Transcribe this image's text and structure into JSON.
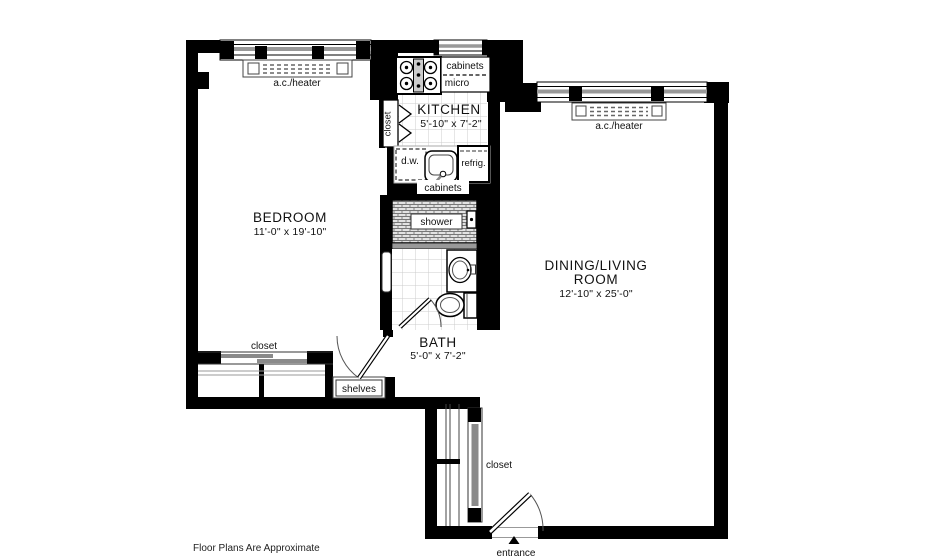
{
  "rooms": {
    "bedroom": {
      "name": "BEDROOM",
      "dims": "11'-0\" x 19'-10\""
    },
    "kitchen": {
      "name": "KITCHEN",
      "dims": "5'-10\" x 7'-2\""
    },
    "bath": {
      "name": "BATH",
      "dims": "5'-0\" x 7'-2\""
    },
    "dining": {
      "name_line1": "DINING/LIVING",
      "name_line2": "ROOM",
      "dims": "12'-10\" x 25'-0\""
    }
  },
  "labels": {
    "ac_heater_bedroom": "a.c./heater",
    "ac_heater_dining": "a.c./heater",
    "cabinets_upper": "cabinets",
    "micro": "micro",
    "kitchen_closet": "closet",
    "dw": "d.w.",
    "refrig": "refrig.",
    "cabinets_lower": "cabinets",
    "shower": "shower",
    "bedroom_closet": "closet",
    "shelves": "shelves",
    "hall_closet": "closet",
    "entrance": "entrance"
  },
  "footer": {
    "note": "Floor Plans Are Approximate"
  },
  "colors": {
    "wall": "#000000",
    "background": "#ffffff",
    "window_gray": "#999999",
    "slider_gray": "#8a8a8a",
    "tile_line": "#cccccc"
  }
}
